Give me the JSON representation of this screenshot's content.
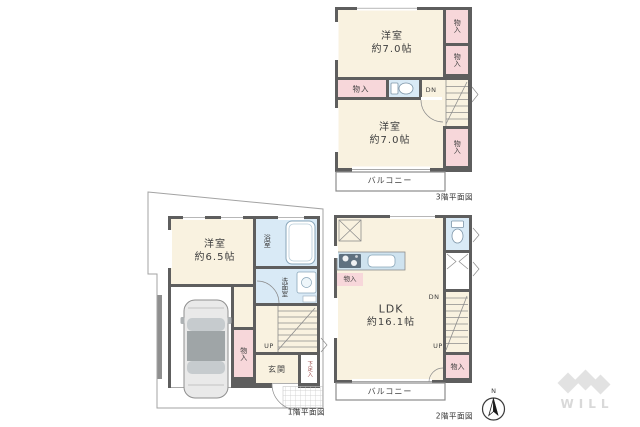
{
  "colors": {
    "wall": "#5e5e5e",
    "floor": "#f9f2e0",
    "closet": "#f7d7da",
    "wet": "#d9eaf6",
    "counter": "#cfe3ef",
    "boundary": "#a3a3a3",
    "text": "#3f3f3f",
    "caption": "#333333",
    "shoe_text": "#9c4a4a",
    "watermark": "#d9d9d9",
    "stove": "#5f7180"
  },
  "floor3": {
    "caption": "3階平面図",
    "room_top": {
      "name": "洋室",
      "size": "約7.0帖"
    },
    "room_bottom": {
      "name": "洋室",
      "size": "約7.0帖"
    },
    "closet_right_top": "物入",
    "closet_right_mid": "物入",
    "closet_hall": "物入",
    "closet_right_bottom": "物入",
    "stairs_down": "DN",
    "balcony": "バルコニー"
  },
  "floor2": {
    "caption": "2階平面図",
    "ldk": {
      "name": "LDK",
      "size": "約16.1帖"
    },
    "closet_kitchen": "物入",
    "closet_south": "物入",
    "stairs_down": "DN",
    "stairs_up": "UP",
    "balcony": "バルコニー"
  },
  "floor1": {
    "caption": "1階平面図",
    "room": {
      "name": "洋室",
      "size": "約6.5帖"
    },
    "bathroom": "浴室",
    "washroom": "洗面室",
    "closet": "物入",
    "stairs_up": "UP",
    "entrance": "玄関",
    "shoe_cabinet": "下足入"
  },
  "compass": {
    "north": "N"
  },
  "watermark": {
    "brand": "WILL"
  }
}
